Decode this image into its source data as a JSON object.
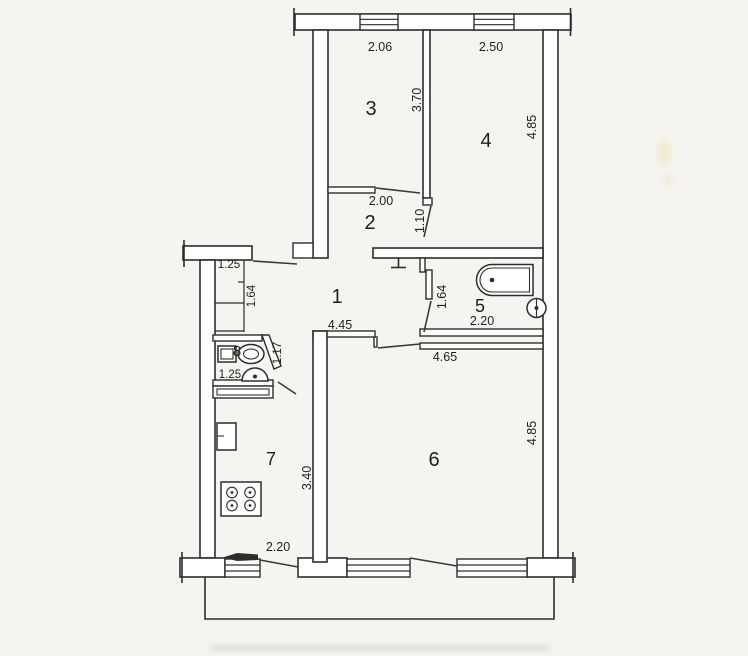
{
  "document": {
    "type": "apartment-floor-plan",
    "description": "Scanned black-and-white architectural floor plan of an apartment with numbered rooms, dimension labels in meters, windows, door swings, a balcony strip and plumbing fixtures"
  },
  "colors": {
    "ink": "#2e2d2b",
    "paper": "#f5f4f1",
    "fill": "#ffffff"
  },
  "rooms": {
    "hallway": {
      "number": "1",
      "width": "4.45"
    },
    "inner_hall": {
      "number": "2",
      "width": "2.00",
      "door_width": "1.10"
    },
    "room3": {
      "number": "3",
      "width": "2.06",
      "depth": "3.70"
    },
    "room4": {
      "number": "4",
      "width": "2.50",
      "depth": "4.85"
    },
    "bathroom": {
      "number": "5",
      "width": "2.20",
      "depth": "1.64"
    },
    "living_room": {
      "number": "6",
      "width": "4.65",
      "depth": "4.85"
    },
    "kitchen": {
      "number": "7",
      "depth": "3.40",
      "balcony_opening": "2.20"
    },
    "toilet": {
      "number": "8",
      "width": "1.25",
      "wall_length": "1.17"
    },
    "entry": {
      "width": "1.25",
      "depth": "1.64"
    }
  },
  "fixtures": [
    "bathtub",
    "bathroom-sink",
    "wc-toilet",
    "toilet-sink",
    "fridge",
    "stove-4-burner"
  ]
}
